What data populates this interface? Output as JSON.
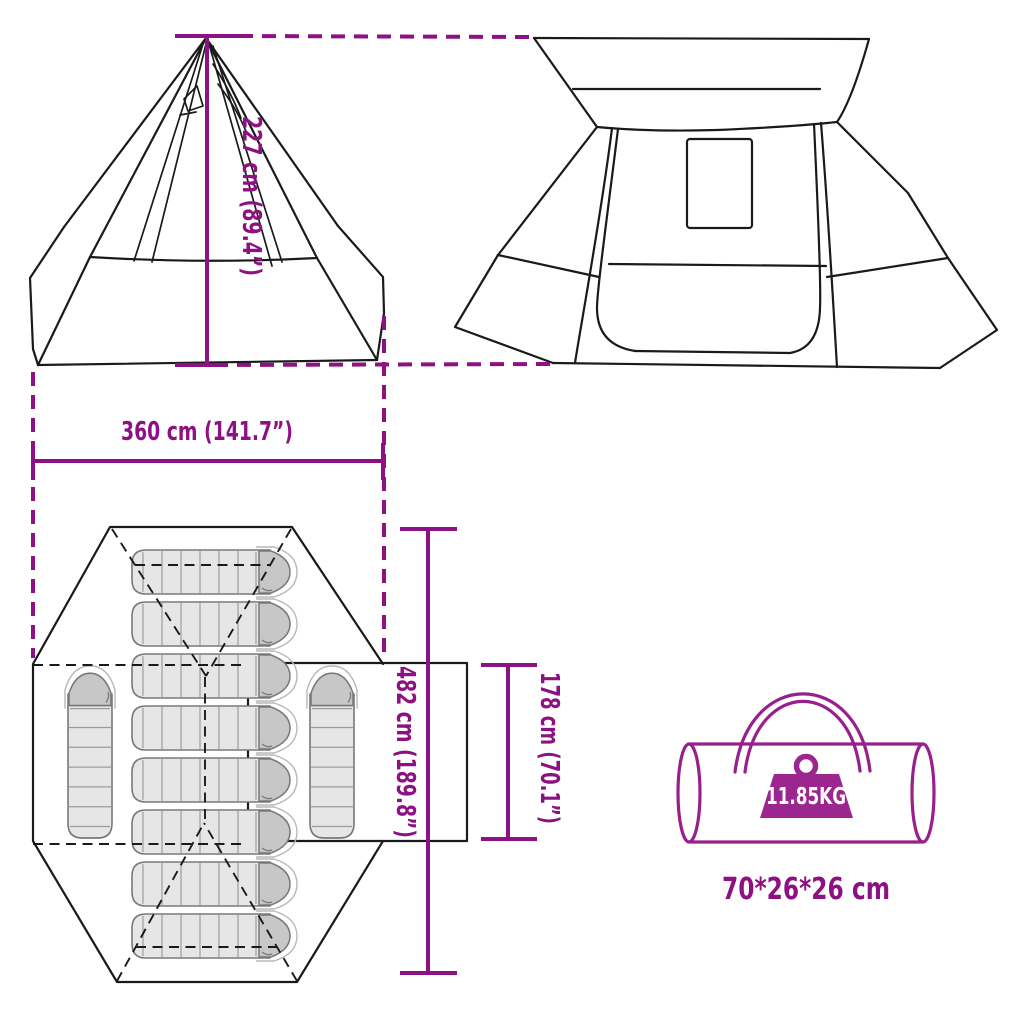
{
  "diagram": {
    "dimensions": {
      "height_label": "227 cm (89.4”)",
      "width_label": "360 cm (141.7”)",
      "length_label": "482 cm (189.8”)",
      "door_height_label": "178 cm (70.1”)"
    },
    "package": {
      "weight_label": "11.85KG",
      "size_label": "70*26*26 cm"
    },
    "floor_plan": {
      "sleeping_bags_horizontal": 8,
      "sleeping_bags_vertical": 2
    },
    "colors": {
      "dimension_purple": "#8D1182",
      "bag_purple": "#97208C",
      "weight_fill": "#9C2690",
      "line_black": "#1A1A1A"
    }
  }
}
